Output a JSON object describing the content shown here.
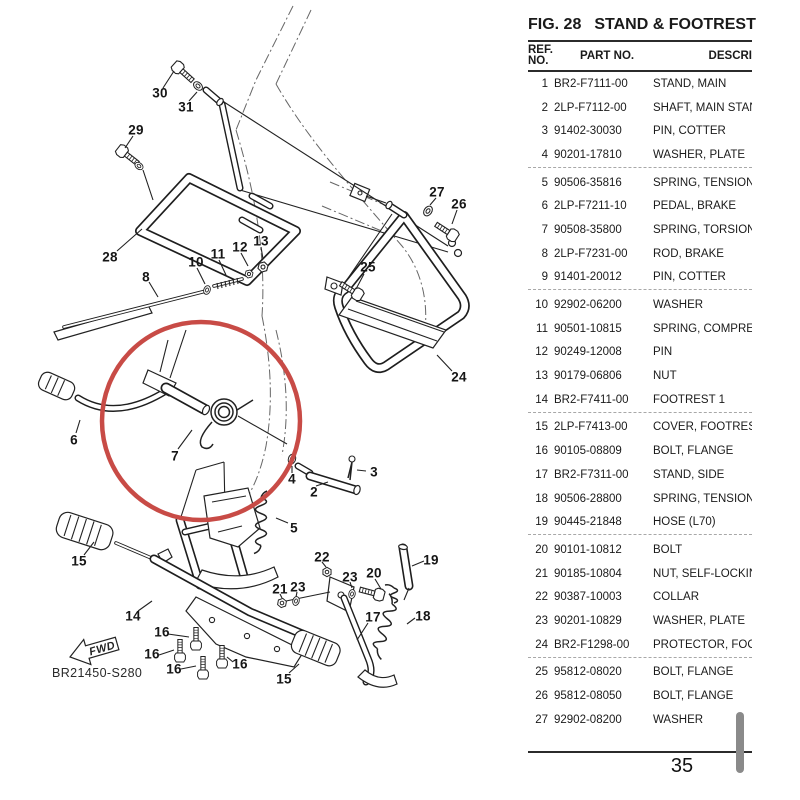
{
  "page": {
    "fig_no": "FIG. 28",
    "fig_name": "STAND & FOOTREST",
    "page_number": "35",
    "drawing_code": "BR21450-S280",
    "fwd_label": "FWD"
  },
  "table": {
    "col_headers": {
      "ref_line1": "REF.",
      "ref_line2": "NO.",
      "part": "PART NO.",
      "desc": "DESCRI"
    },
    "rows": [
      {
        "ref": "1",
        "part": "BR2-F7111-00",
        "desc": "STAND, MAIN"
      },
      {
        "ref": "2",
        "part": "2LP-F7112-00",
        "desc": "SHAFT, MAIN STAND"
      },
      {
        "ref": "3",
        "part": "91402-30030",
        "desc": "PIN, COTTER"
      },
      {
        "ref": "4",
        "part": "90201-17810",
        "desc": "WASHER, PLATE"
      },
      {
        "ref": "5",
        "part": "90506-35816",
        "desc": "SPRING, TENSION"
      },
      {
        "ref": "6",
        "part": "2LP-F7211-10",
        "desc": "PEDAL, BRAKE"
      },
      {
        "ref": "7",
        "part": "90508-35800",
        "desc": "SPRING, TORSION"
      },
      {
        "ref": "8",
        "part": "2LP-F7231-00",
        "desc": "ROD, BRAKE"
      },
      {
        "ref": "9",
        "part": "91401-20012",
        "desc": "PIN, COTTER"
      },
      {
        "ref": "10",
        "part": "92902-06200",
        "desc": "WASHER"
      },
      {
        "ref": "11",
        "part": "90501-10815",
        "desc": "SPRING, COMPRESS"
      },
      {
        "ref": "12",
        "part": "90249-12008",
        "desc": "PIN"
      },
      {
        "ref": "13",
        "part": "90179-06806",
        "desc": "NUT"
      },
      {
        "ref": "14",
        "part": "BR2-F7411-00",
        "desc": "FOOTREST 1"
      },
      {
        "ref": "15",
        "part": "2LP-F7413-00",
        "desc": "COVER, FOOTREST"
      },
      {
        "ref": "16",
        "part": "90105-08809",
        "desc": "BOLT, FLANGE"
      },
      {
        "ref": "17",
        "part": "BR2-F7311-00",
        "desc": "STAND, SIDE"
      },
      {
        "ref": "18",
        "part": "90506-28800",
        "desc": "SPRING, TENSION"
      },
      {
        "ref": "19",
        "part": "90445-21848",
        "desc": "HOSE (L70)"
      },
      {
        "ref": "20",
        "part": "90101-10812",
        "desc": "BOLT"
      },
      {
        "ref": "21",
        "part": "90185-10804",
        "desc": "NUT, SELF-LOCKING"
      },
      {
        "ref": "22",
        "part": "90387-10003",
        "desc": "COLLAR"
      },
      {
        "ref": "23",
        "part": "90201-10829",
        "desc": "WASHER, PLATE"
      },
      {
        "ref": "24",
        "part": "BR2-F1298-00",
        "desc": "PROTECTOR, FOOT"
      },
      {
        "ref": "25",
        "part": "95812-08020",
        "desc": "BOLT, FLANGE"
      },
      {
        "ref": "26",
        "part": "95812-08050",
        "desc": "BOLT, FLANGE"
      },
      {
        "ref": "27",
        "part": "92902-08200",
        "desc": "WASHER"
      }
    ]
  },
  "diagram": {
    "highlight_color": "#c84b46",
    "callouts": [
      {
        "text": "30",
        "x": 160,
        "y": 93
      },
      {
        "text": "31",
        "x": 186,
        "y": 107
      },
      {
        "text": "29",
        "x": 136,
        "y": 130
      },
      {
        "text": "28",
        "x": 110,
        "y": 257
      },
      {
        "text": "8",
        "x": 146,
        "y": 277
      },
      {
        "text": "10",
        "x": 196,
        "y": 262
      },
      {
        "text": "11",
        "x": 218,
        "y": 254
      },
      {
        "text": "12",
        "x": 240,
        "y": 247
      },
      {
        "text": "13",
        "x": 261,
        "y": 241
      },
      {
        "text": "27",
        "x": 437,
        "y": 192
      },
      {
        "text": "26",
        "x": 459,
        "y": 204
      },
      {
        "text": "25",
        "x": 368,
        "y": 267
      },
      {
        "text": "24",
        "x": 459,
        "y": 377
      },
      {
        "text": "6",
        "x": 74,
        "y": 440
      },
      {
        "text": "7",
        "x": 175,
        "y": 456
      },
      {
        "text": "4",
        "x": 292,
        "y": 479
      },
      {
        "text": "2",
        "x": 314,
        "y": 492
      },
      {
        "text": "3",
        "x": 374,
        "y": 472
      },
      {
        "text": "5",
        "x": 294,
        "y": 528
      },
      {
        "text": "15",
        "x": 79,
        "y": 561
      },
      {
        "text": "22",
        "x": 322,
        "y": 557
      },
      {
        "text": "19",
        "x": 431,
        "y": 560
      },
      {
        "text": "20",
        "x": 374,
        "y": 573
      },
      {
        "text": "23",
        "x": 350,
        "y": 577
      },
      {
        "text": "23",
        "x": 298,
        "y": 587
      },
      {
        "text": "21",
        "x": 280,
        "y": 589
      },
      {
        "text": "18",
        "x": 423,
        "y": 616
      },
      {
        "text": "17",
        "x": 373,
        "y": 617
      },
      {
        "text": "14",
        "x": 133,
        "y": 616
      },
      {
        "text": "16",
        "x": 162,
        "y": 632
      },
      {
        "text": "16",
        "x": 152,
        "y": 654
      },
      {
        "text": "16",
        "x": 174,
        "y": 669
      },
      {
        "text": "16",
        "x": 240,
        "y": 664
      },
      {
        "text": "15",
        "x": 284,
        "y": 679
      }
    ]
  }
}
